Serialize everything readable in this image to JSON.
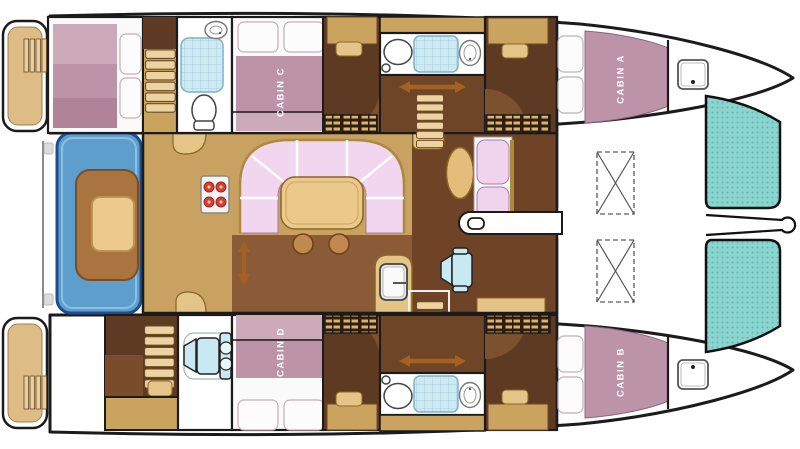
{
  "plan": {
    "vessel_type": "catamaran sailing yacht deck plan, bow to the right",
    "cabins": {
      "a": "CABIN A",
      "b": "CABIN B",
      "c": "CABIN C",
      "d": "CABIN D"
    },
    "areas": [
      "aft swim platforms with boarding ladders",
      "port aft cabin double berth",
      "aft cockpit with U-shaped bench and table",
      "galley with 4-burner stove and sink",
      "salon with U-shaped settee and table",
      "navigation area with oval table, bench seat and chair",
      "two hull corridors with companionway steps",
      "two hull bathrooms with toilet, shower and washbasin",
      "aft port bathroom with shower and toilet",
      "aft starboard desk room with chair",
      "foredeck with two deck lockers",
      "bow trampolines"
    ],
    "fixtures": [
      "bed-icon",
      "pillow-icon",
      "toilet-icon",
      "shower-icon",
      "washbasin-icon",
      "stove-icon",
      "sofa-icon",
      "table-icon",
      "stool-icon",
      "steps-icon",
      "ladder-icon",
      "deck-hatch-icon",
      "locker-hatch-icon",
      "louver-locker-icon",
      "door-icon",
      "door-swing-icon",
      "chair-icon",
      "passage-arrow-icon",
      "cleat-icon"
    ],
    "palette": {
      "outline": "#1b1b1b",
      "deck_white": "#ffffff",
      "platform_tan": "#ddbd85",
      "wood_floor": "#c9a160",
      "walkway_brown": "#8b5b38",
      "cabin_floor_dark": "#5e3a22",
      "door_arc_brown": "#7c5130",
      "counter_tan": "#e5c488",
      "step_tan": "#ecd3a0",
      "mattress_mauve": "#bd93a8",
      "mattress_mauve_light": "#cdaaba",
      "sofa_pink": "#f2d5ef",
      "sofa_trim_gold": "#ab8b3e",
      "cockpit_blue": "#5e9ecd",
      "cockpit_blue_border": "#1d4d90",
      "trampoline_teal": "#8bd5d0",
      "tile_blue": "#cfe9f3",
      "chair_blue": "#c9e9f2",
      "burner_red": "#d6403a",
      "arrow_orange": "#a6601f"
    }
  }
}
